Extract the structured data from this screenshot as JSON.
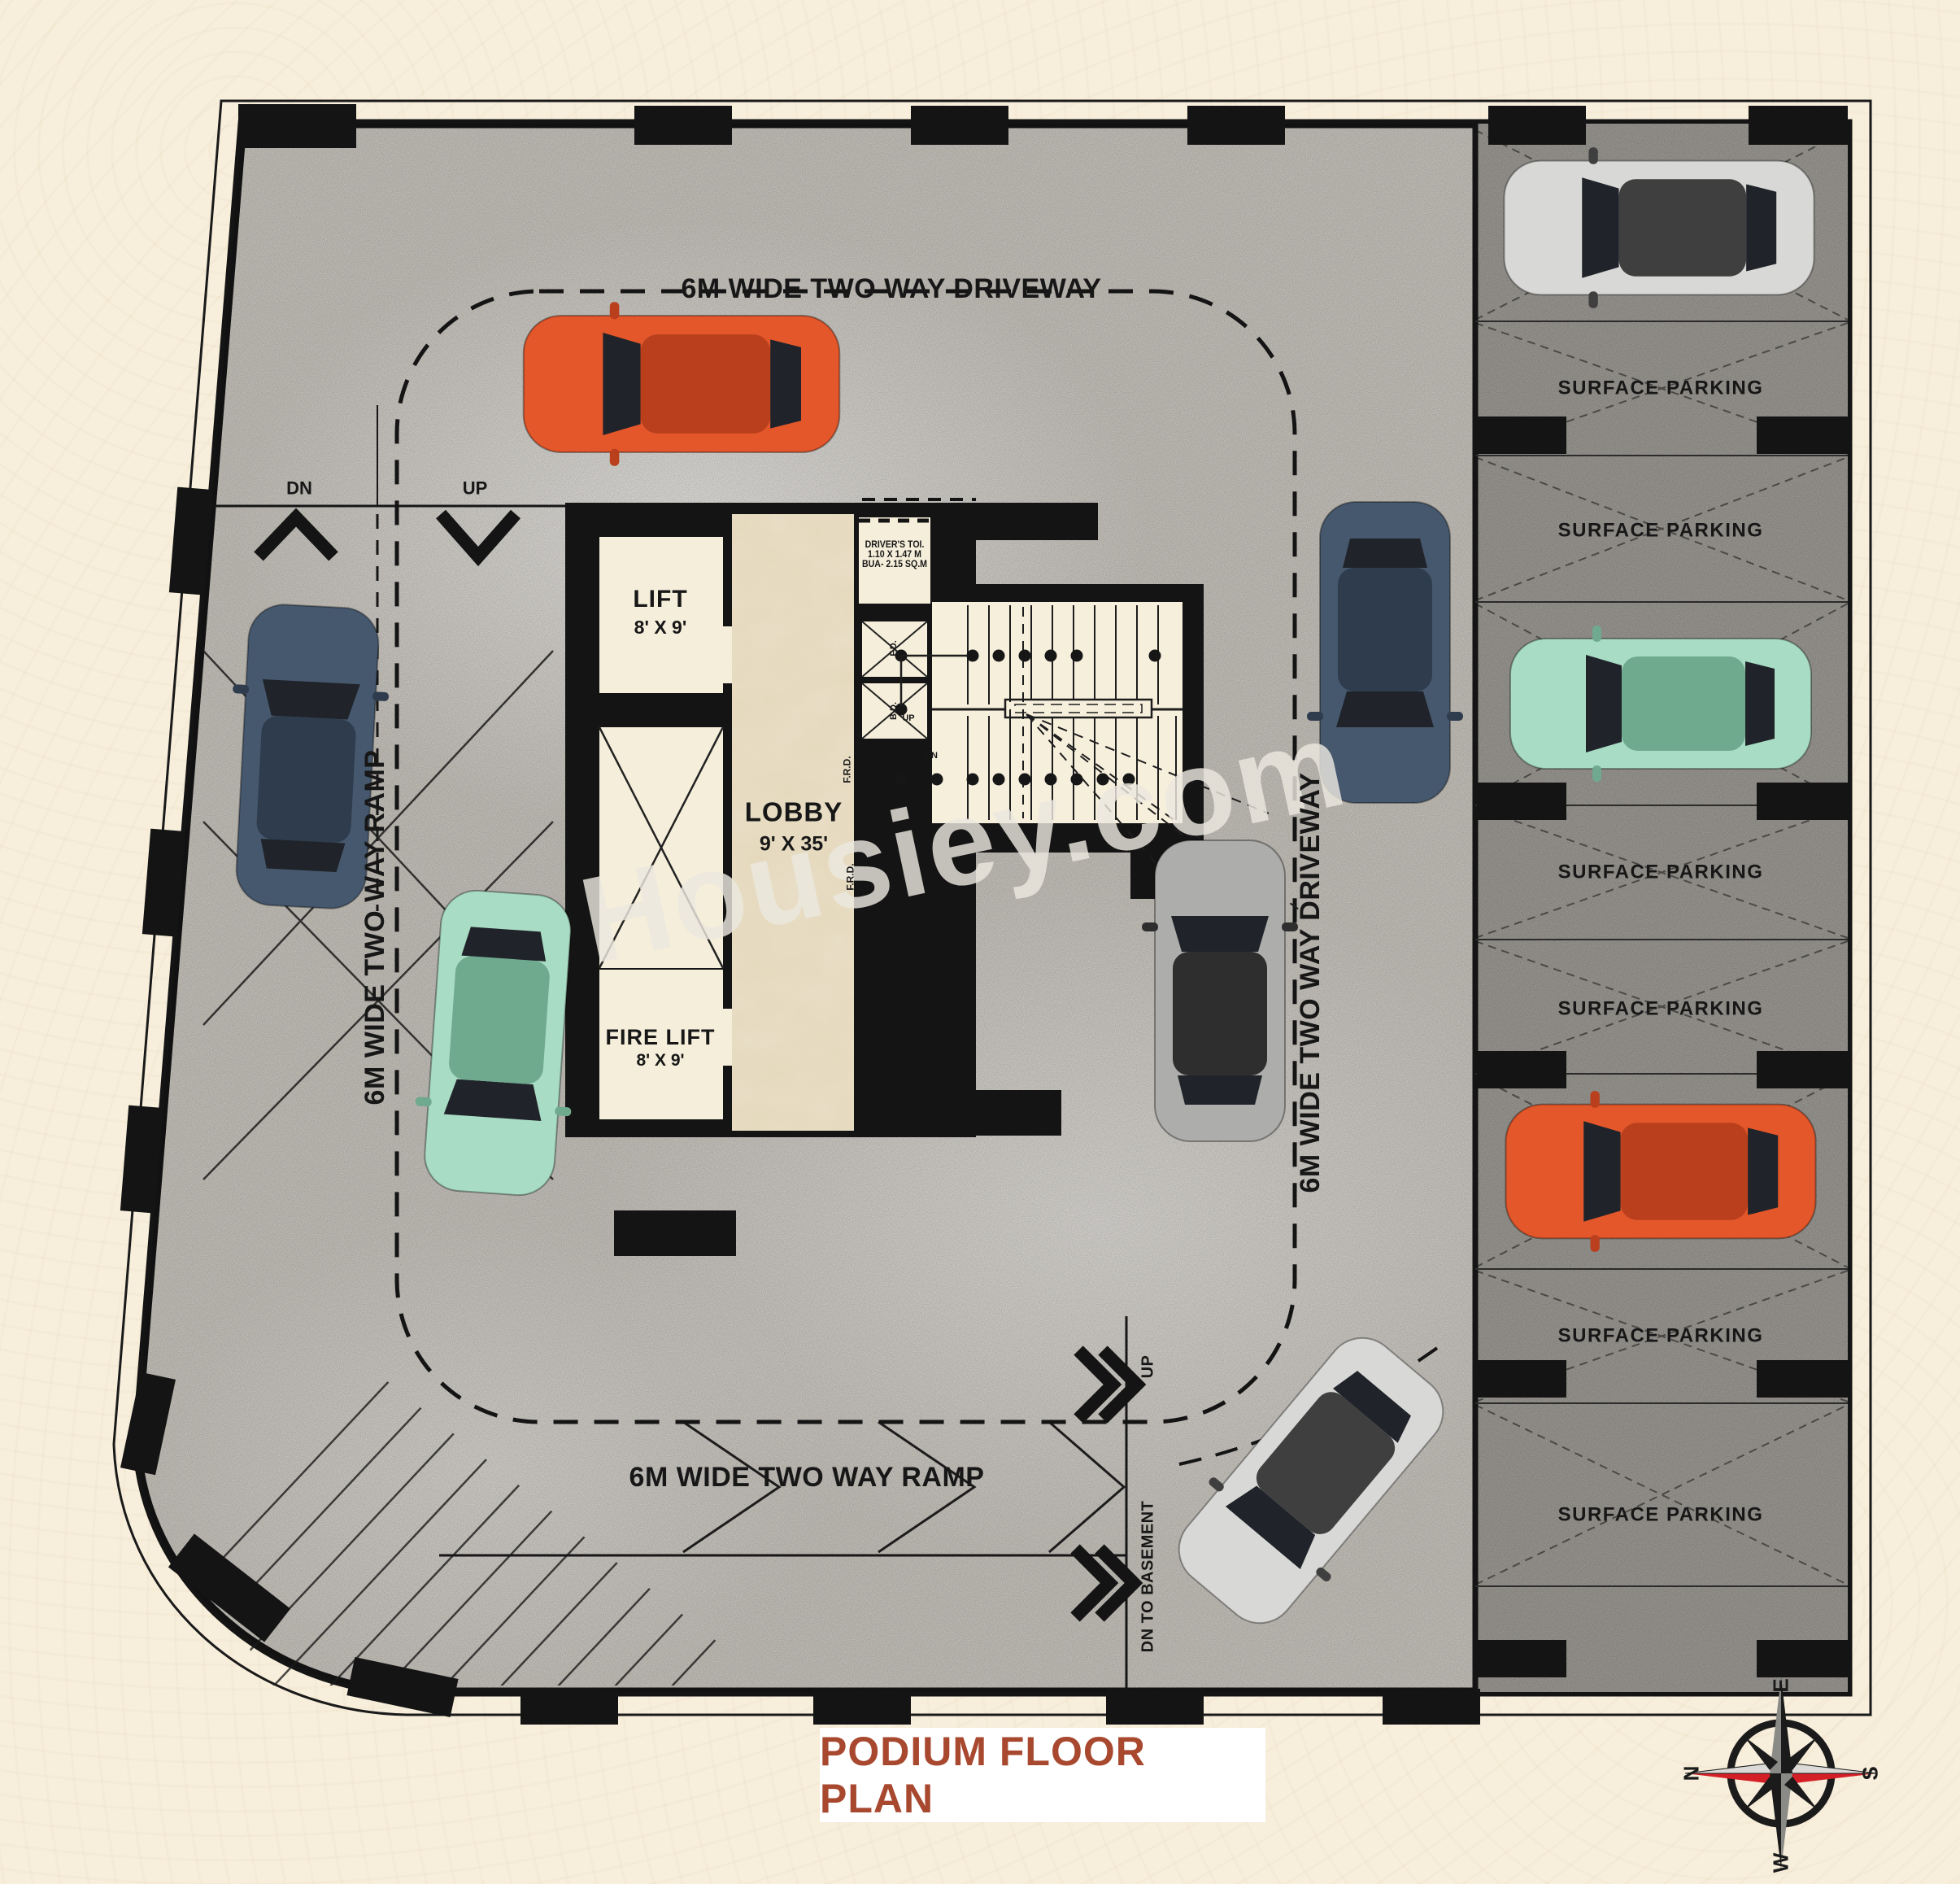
{
  "title": {
    "label": "PODIUM FLOOR PLAN"
  },
  "watermark": "Housiey.com",
  "labels": {
    "driveway_top": "6M WIDE TWO WAY DRIVEWAY",
    "driveway_right": "6M WIDE TWO WAY DRIVEWAY",
    "ramp_left": "6M WIDE TWO WAY RAMP",
    "ramp_bottom": "6M WIDE TWO WAY RAMP",
    "dn": "DN",
    "up": "UP",
    "basement_up": "UP",
    "basement_dn": "DN TO BASEMENT"
  },
  "rooms": {
    "lift": {
      "name": "LIFT",
      "size": "8' X 9'"
    },
    "fire_lift": {
      "name": "FIRE LIFT",
      "size": "8' X 9'"
    },
    "lobby": {
      "name": "LOBBY",
      "size": "9' X 35'"
    },
    "drivers_toilet": {
      "line1": "DRIVER'S TOI.",
      "line2": "1.10 X 1.47 M",
      "line3": "BUA- 2.15 SQ.M"
    }
  },
  "stairs": {
    "up": "UP",
    "dn": "DN",
    "fd": "F.D.",
    "bd": "B.D.",
    "frd": "F.R.D."
  },
  "parking": {
    "stall_label": "SURFACE PARKING",
    "empty_stall_count": 6,
    "car_stall_count": 3
  },
  "compass": {
    "n": "N",
    "e": "E",
    "s": "S",
    "w": "W"
  },
  "colors": {
    "page_bg": "#f7eedb",
    "floor": "#cbc7c0",
    "stall_floor": "#a29f99",
    "wall": "#141414",
    "room_cream": "#f5eeda",
    "marble": "#e9dfc7",
    "title_text": "#a7482f",
    "compass_red": "#d51f27",
    "car_orange": "#e4572a",
    "car_blue": "#46586e",
    "car_teal": "#a9dcc4",
    "car_silver": "#d8d8d6",
    "car_gray": "#adadab"
  }
}
